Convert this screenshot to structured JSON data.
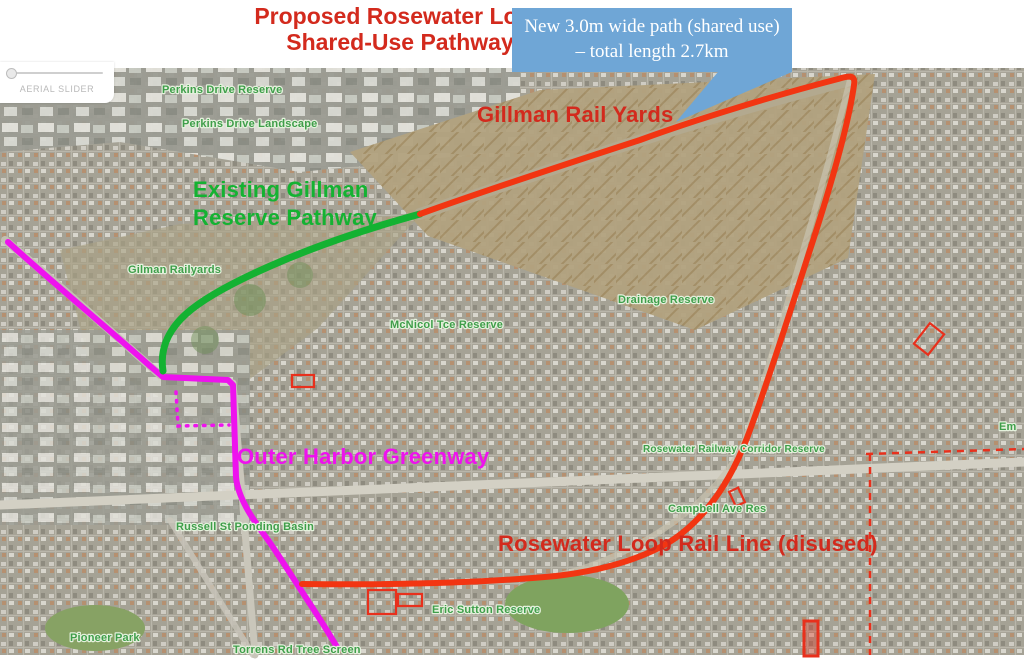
{
  "title": {
    "line1": "Proposed Rosewater Loop",
    "line2": "Shared-Use Pathway"
  },
  "callout": {
    "text": "New 3.0m wide path (shared use) – total length 2.7km"
  },
  "aerial_slider": {
    "label": "AERIAL SLIDER"
  },
  "colors": {
    "title_red": "#d32a1d",
    "route_red": "#f23512",
    "route_green": "#14b232",
    "route_magenta": "#ee12ee",
    "callout_blue": "#6fa6d6",
    "map_label_green": "#3f9e4a",
    "marker_red": "#e8301c"
  },
  "route_labels": {
    "rail_yards": "Gillman Rail Yards",
    "existing_line1": "Existing Gillman",
    "existing_line2": "Reserve Pathway",
    "greenway": "Outer Harbor Greenway",
    "loop": "Rosewater Loop Rail Line (disused)"
  },
  "map_labels": [
    {
      "text": "Perkins Drive Reserve"
    },
    {
      "text": "Perkins Drive Landscape"
    },
    {
      "text": "Gilman Railyards"
    },
    {
      "text": "McNicol Tce Reserve"
    },
    {
      "text": "Drainage Reserve"
    },
    {
      "text": "Rosewater Railway Corridor Reserve"
    },
    {
      "text": "Campbell Ave Res"
    },
    {
      "text": "Russell St Ponding Basin"
    },
    {
      "text": "Eric Sutton Reserve"
    },
    {
      "text": "Pioneer Park"
    },
    {
      "text": "Torrens Rd Tree Screen"
    },
    {
      "text": "Em"
    }
  ]
}
